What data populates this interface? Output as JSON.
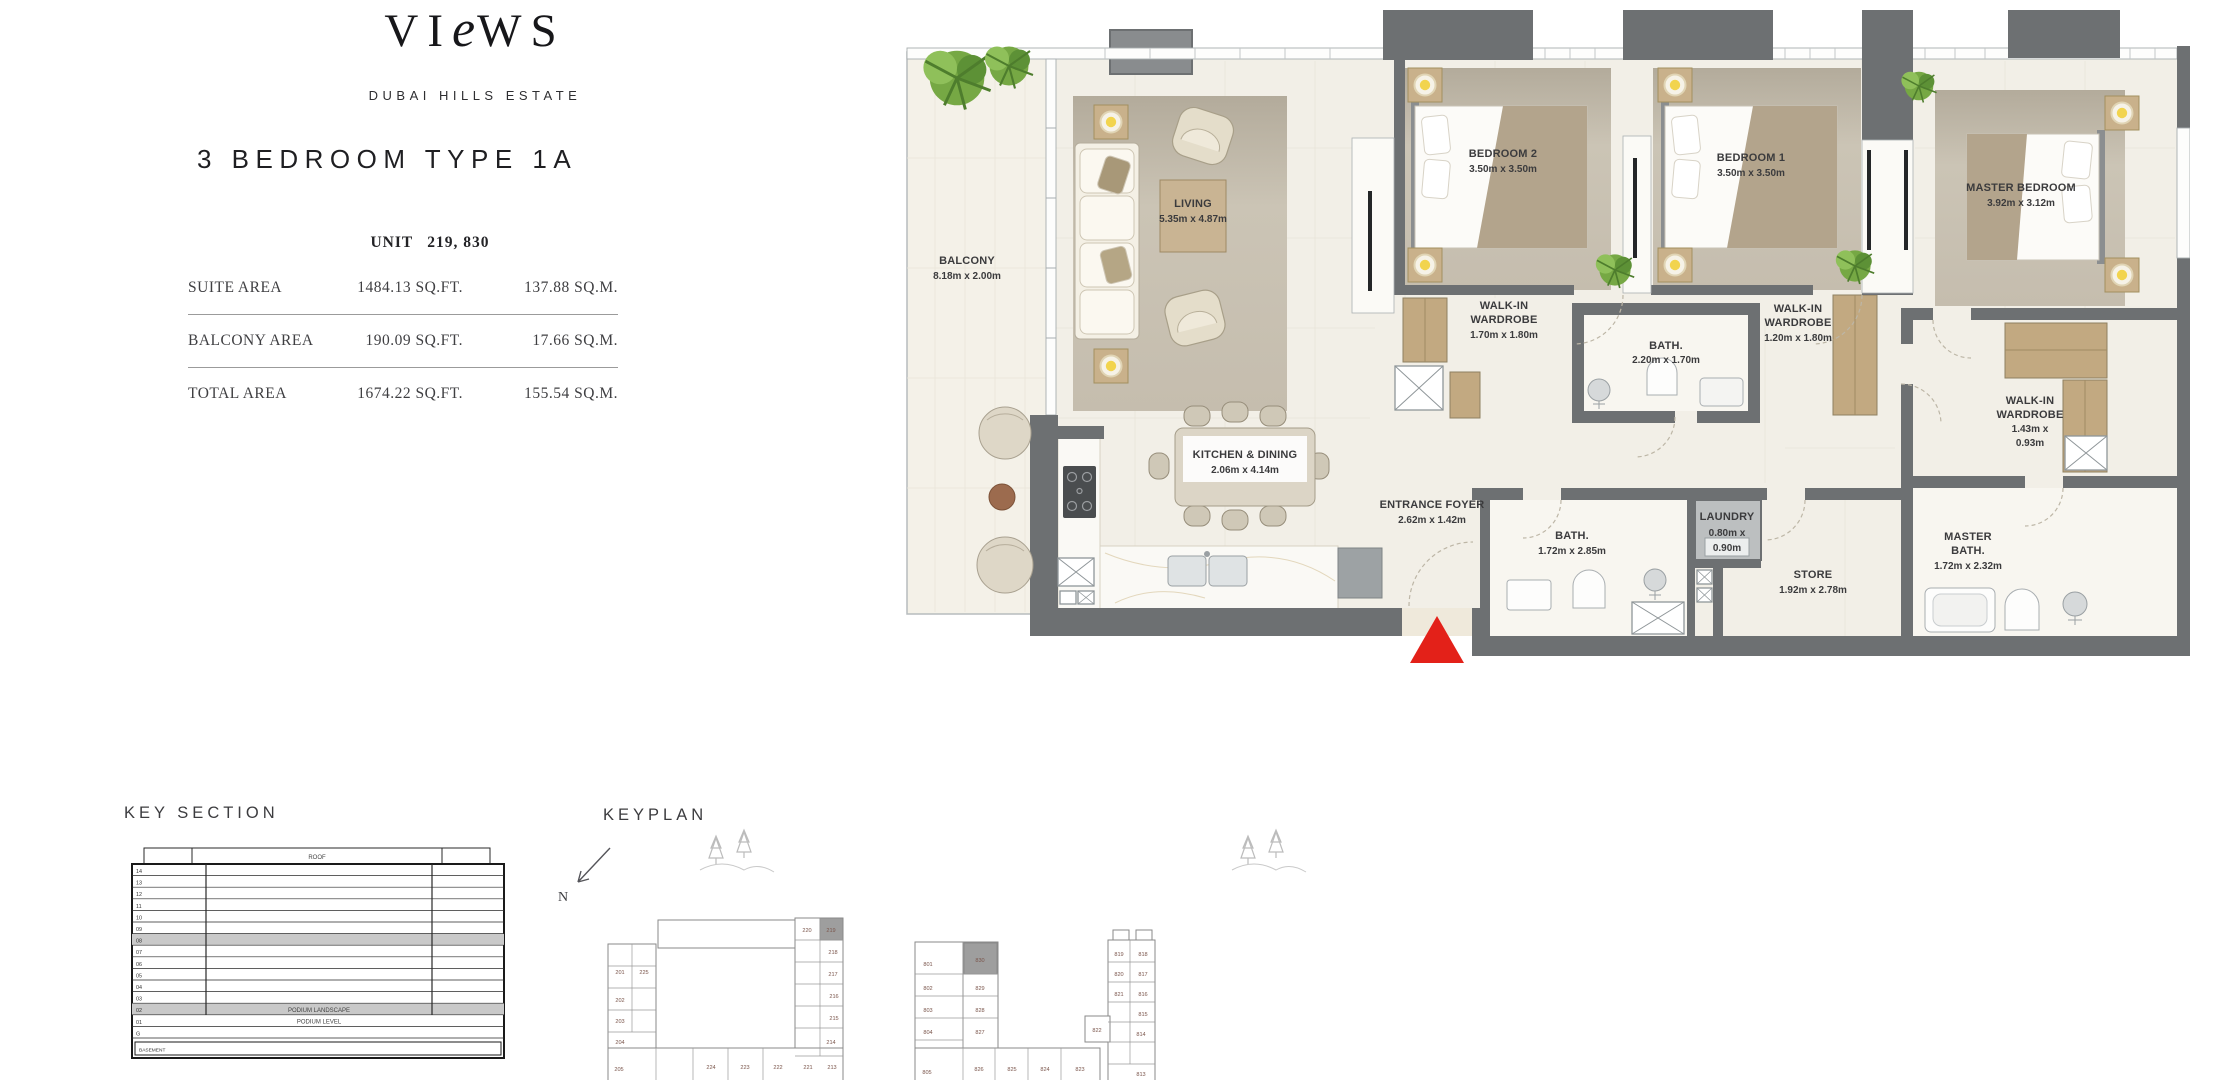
{
  "brand": {
    "logo_pre": "VI",
    "logo_e": "e",
    "logo_post": "WS",
    "estate": "DUBAI HILLS ESTATE"
  },
  "header": {
    "title": "3 BEDROOM TYPE 1A",
    "unit_label": "UNIT",
    "unit_numbers": "219, 830"
  },
  "area_table": {
    "rows": [
      {
        "label": "SUITE AREA",
        "sqft": "1484.13 SQ.FT.",
        "sqm": "137.88 SQ.M."
      },
      {
        "label": "BALCONY AREA",
        "sqft": "190.09 SQ.FT.",
        "sqm": "17.66 SQ.M."
      },
      {
        "label": "TOTAL AREA",
        "sqft": "1674.22 SQ.FT.",
        "sqm": "155.54 SQ.M."
      }
    ]
  },
  "plan": {
    "rooms": {
      "balcony": {
        "name": "BALCONY",
        "dims": "8.18m x 2.00m"
      },
      "living": {
        "name": "LIVING",
        "dims": "5.35m x 4.87m"
      },
      "bedroom2": {
        "name": "BEDROOM 2",
        "dims": "3.50m x 3.50m"
      },
      "bedroom1": {
        "name": "BEDROOM 1",
        "dims": "3.50m x 3.50m"
      },
      "master_bedroom": {
        "name": "MASTER BEDROOM",
        "dims": "3.92m x 3.12m"
      },
      "ww_bedroom2": {
        "l1": "WALK-IN",
        "l2": "WARDROBE",
        "l3": "1.70m x 1.80m"
      },
      "ww_bedroom1": {
        "l1": "WALK-IN",
        "l2": "WARDROBE",
        "l3": "1.20m x 1.80m"
      },
      "ww_master": {
        "l1": "WALK-IN",
        "l2": "WARDROBE",
        "l3": "1.43m x",
        "l4": "0.93m"
      },
      "bath_shared": {
        "name": "BATH.",
        "dims": "2.20m x 1.70m"
      },
      "bath2": {
        "name": "BATH.",
        "dims": "1.72m x 2.85m"
      },
      "master_bath": {
        "l1": "MASTER",
        "l2": "BATH.",
        "l3": "1.72m x 2.32m"
      },
      "laundry": {
        "l1": "LAUNDRY",
        "l2": "0.80m x",
        "l3": "0.90m"
      },
      "store": {
        "name": "STORE",
        "dims": "1.92m x 2.78m"
      },
      "kitchen_dining": {
        "name": "KITCHEN & DINING",
        "dims": "2.06m x 4.14m"
      },
      "entrance_foyer": {
        "name": "ENTRANCE FOYER",
        "dims": "2.62m x 1.42m"
      }
    }
  },
  "key_section": {
    "title": "KEY SECTION",
    "roof": "ROOF",
    "floors": [
      "14",
      "13",
      "12",
      "11",
      "10",
      "09",
      "08",
      "07",
      "06",
      "05",
      "04",
      "03"
    ],
    "highlighted_floor": "08",
    "podium_landscape_floor": "02",
    "podium_landscape": "PODIUM LANDSCAPE",
    "podium_level_floor": "01",
    "podium_level": "PODIUM LEVEL",
    "ground": "G",
    "basement": "BASEMENT"
  },
  "keyplan": {
    "title": "KEYPLAN",
    "north": "N",
    "building1": {
      "highlighted": "219",
      "units": [
        "201",
        "225",
        "202",
        "203",
        "204",
        "205",
        "224",
        "223",
        "222",
        "221",
        "213",
        "214",
        "215",
        "216",
        "217",
        "218",
        "220",
        "219"
      ]
    },
    "building2": {
      "highlighted": "830",
      "units": [
        "801",
        "830",
        "802",
        "829",
        "803",
        "828",
        "804",
        "827",
        "805",
        "826",
        "825",
        "824",
        "823",
        "819",
        "818",
        "820",
        "817",
        "821",
        "816",
        "822",
        "815",
        "814",
        "813"
      ]
    }
  },
  "colors": {
    "wall": "#6d7072",
    "floor": "#f2efe7",
    "wood": "#c2a981",
    "accent_red": "#e32119",
    "highlight_gray": "#9e9e9e"
  }
}
